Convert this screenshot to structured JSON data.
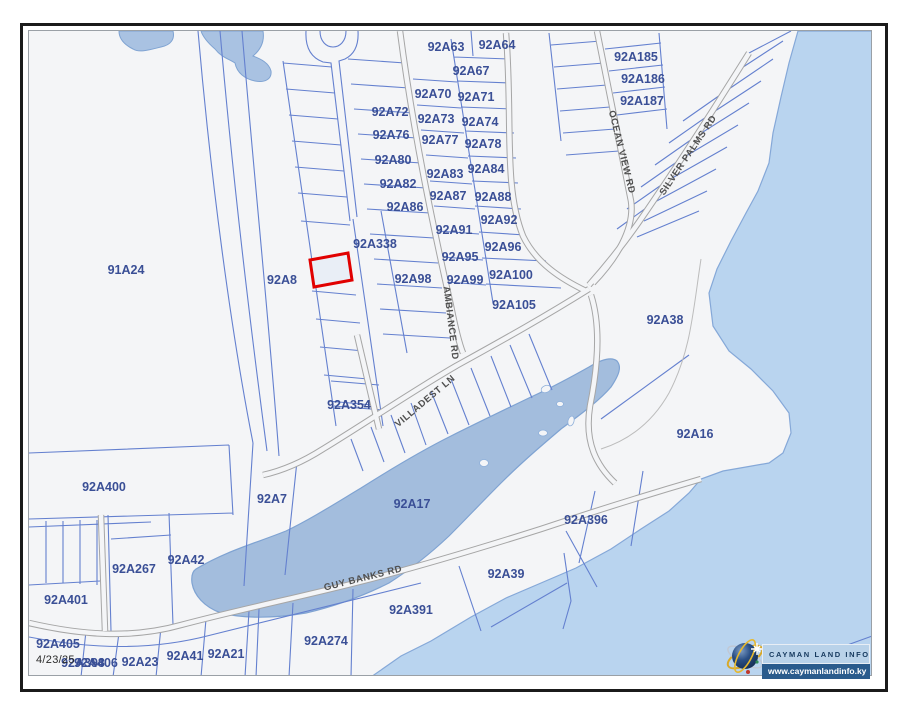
{
  "map": {
    "date_label": "4/23/25",
    "colors": {
      "background": "#f4f5f7",
      "parcel_line": "#6480cf",
      "road_casing": "#a6a6a6",
      "sea": "#b9d4ef",
      "coast_stroke": "#85a8d8",
      "pond": "#a3bddd",
      "pond_stroke": "#7fa3d2",
      "parcel_label": "#3a4f96",
      "road_label": "#4f4f4f",
      "highlight_stroke": "#e10000"
    },
    "highlighted_parcel": {
      "note": "selected parcel outlined in red",
      "stroke": "#e10000"
    },
    "parcels": [
      {
        "t": "92A63",
        "x": 445,
        "y": 46
      },
      {
        "t": "92A64",
        "x": 496,
        "y": 44
      },
      {
        "t": "92A67",
        "x": 470,
        "y": 70
      },
      {
        "t": "92A70",
        "x": 432,
        "y": 93
      },
      {
        "t": "92A71",
        "x": 475,
        "y": 96
      },
      {
        "t": "92A72",
        "x": 389,
        "y": 111
      },
      {
        "t": "92A73",
        "x": 435,
        "y": 118
      },
      {
        "t": "92A74",
        "x": 479,
        "y": 121
      },
      {
        "t": "92A76",
        "x": 390,
        "y": 134
      },
      {
        "t": "92A77",
        "x": 439,
        "y": 139
      },
      {
        "t": "92A78",
        "x": 482,
        "y": 143
      },
      {
        "t": "92A80",
        "x": 392,
        "y": 159
      },
      {
        "t": "92A82",
        "x": 397,
        "y": 183
      },
      {
        "t": "92A83",
        "x": 444,
        "y": 173
      },
      {
        "t": "92A84",
        "x": 485,
        "y": 168
      },
      {
        "t": "92A86",
        "x": 404,
        "y": 206
      },
      {
        "t": "92A87",
        "x": 447,
        "y": 195
      },
      {
        "t": "92A88",
        "x": 492,
        "y": 196
      },
      {
        "t": "92A91",
        "x": 453,
        "y": 229
      },
      {
        "t": "92A92",
        "x": 498,
        "y": 219
      },
      {
        "t": "92A95",
        "x": 459,
        "y": 256
      },
      {
        "t": "92A96",
        "x": 502,
        "y": 246
      },
      {
        "t": "92A98",
        "x": 412,
        "y": 278
      },
      {
        "t": "92A99",
        "x": 464,
        "y": 279
      },
      {
        "t": "92A100",
        "x": 510,
        "y": 274
      },
      {
        "t": "92A105",
        "x": 513,
        "y": 304
      },
      {
        "t": "92A338",
        "x": 374,
        "y": 243
      },
      {
        "t": "92A8",
        "x": 281,
        "y": 279
      },
      {
        "t": "91A24",
        "x": 125,
        "y": 269
      },
      {
        "t": "92A185",
        "x": 635,
        "y": 56
      },
      {
        "t": "92A186",
        "x": 642,
        "y": 78
      },
      {
        "t": "92A187",
        "x": 641,
        "y": 100
      },
      {
        "t": "92A354",
        "x": 348,
        "y": 404
      },
      {
        "t": "92A38",
        "x": 664,
        "y": 319
      },
      {
        "t": "92A16",
        "x": 694,
        "y": 433
      },
      {
        "t": "92A400",
        "x": 103,
        "y": 486
      },
      {
        "t": "92A7",
        "x": 271,
        "y": 498
      },
      {
        "t": "92A42",
        "x": 185,
        "y": 559
      },
      {
        "t": "92A267",
        "x": 133,
        "y": 568
      },
      {
        "t": "92A401",
        "x": 65,
        "y": 599
      },
      {
        "t": "92A405",
        "x": 57,
        "y": 643
      },
      {
        "t": "92A17",
        "x": 411,
        "y": 503
      },
      {
        "t": "92A396",
        "x": 585,
        "y": 519
      },
      {
        "t": "92A39",
        "x": 505,
        "y": 573
      },
      {
        "t": "92A391",
        "x": 410,
        "y": 609
      },
      {
        "t": "92A274",
        "x": 325,
        "y": 640
      },
      {
        "t": "92A23",
        "x": 139,
        "y": 661
      },
      {
        "t": "92A41",
        "x": 184,
        "y": 655
      },
      {
        "t": "92A21",
        "x": 225,
        "y": 653
      },
      {
        "t": "92A398",
        "x": 82,
        "y": 662
      },
      {
        "t": "92A406",
        "x": 95,
        "y": 662
      }
    ],
    "roads": [
      {
        "t": "AMBIANCE RD",
        "x": 450,
        "y": 322,
        "r": 83
      },
      {
        "t": "VILLADEST LN",
        "x": 424,
        "y": 400,
        "r": -40
      },
      {
        "t": "OCEAN VIEW RD",
        "x": 621,
        "y": 151,
        "r": 76
      },
      {
        "t": "SILVER PALMS RD",
        "x": 687,
        "y": 154,
        "r": -56
      },
      {
        "t": "GUY BANKS RD",
        "x": 362,
        "y": 577,
        "r": -14
      }
    ]
  },
  "logo": {
    "title": "CAYMAN LAND INFO",
    "url": "www.caymanlandinfo.ky"
  }
}
